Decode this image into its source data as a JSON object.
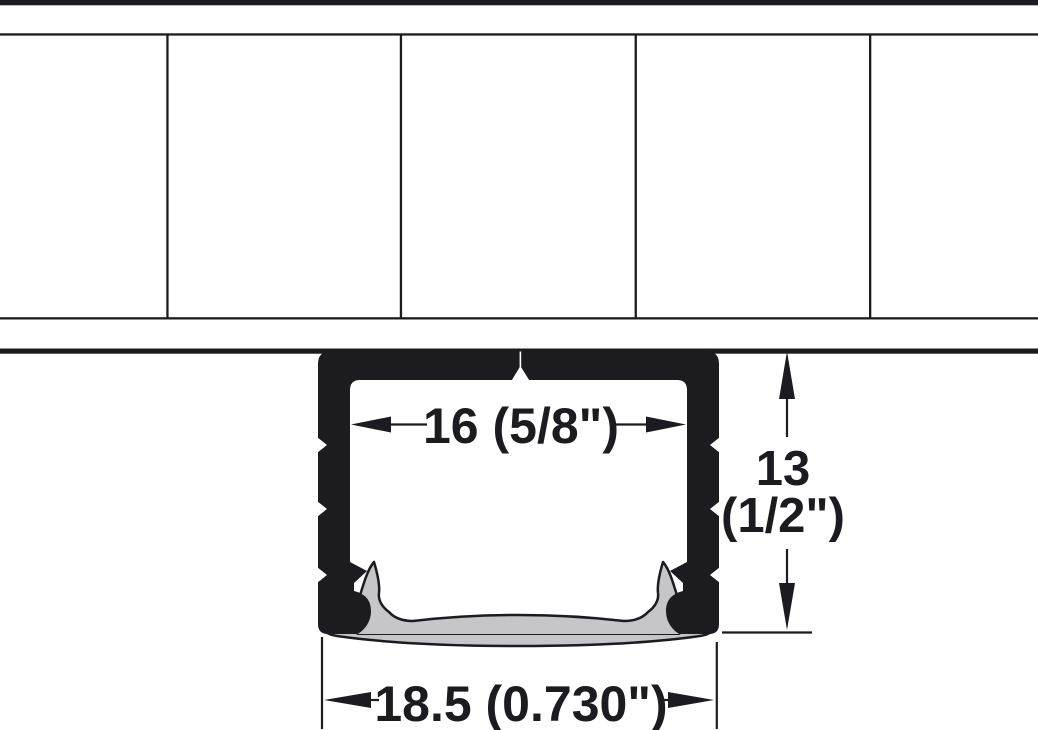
{
  "diagram": {
    "type": "technical-drawing",
    "subject": "recessed-aluminium-led-profile-cross-section",
    "colors": {
      "ink": "#1b1b20",
      "lens_gray": "#c6c6c9",
      "background": "#ffffff"
    },
    "dimensions": {
      "inner_width": {
        "label": "16 (5/8\")"
      },
      "height": {
        "line1": "13",
        "line2": "(1/2\")"
      },
      "outer_width": {
        "label": "18.5 (0.730\")"
      }
    }
  }
}
